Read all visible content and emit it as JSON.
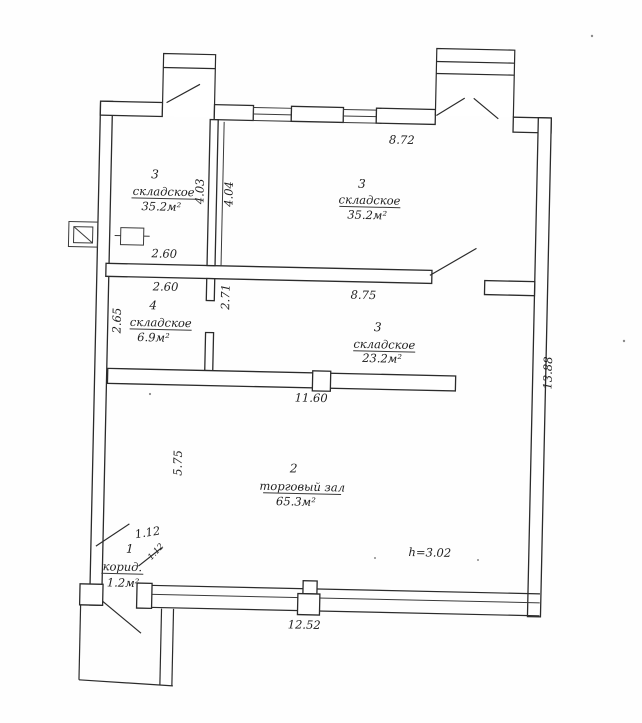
{
  "plan": {
    "rooms": [
      {
        "id": "storage-top-left",
        "number": "3",
        "name": "складское",
        "area": "35.2м²"
      },
      {
        "id": "storage-top-right",
        "number": "3",
        "name": "складское",
        "area": "35.2м²"
      },
      {
        "id": "storage-small",
        "number": "4",
        "name": "складское",
        "area": "6.9м²"
      },
      {
        "id": "storage-middle",
        "number": "3",
        "name": "складское",
        "area": "23.2м²"
      },
      {
        "id": "trade-hall",
        "number": "2",
        "name": "торговый зал",
        "area": "65.3м²"
      },
      {
        "id": "corridor",
        "number": "1",
        "name": "корид.",
        "area": "1.2м²"
      }
    ],
    "dimensions": {
      "top_window_run": "8.72",
      "room_tl_height": "4.03",
      "room_tr_height": "4.04",
      "storage_tl_width": "2.60",
      "storage_small_width": "2.60",
      "partition_height": "2.71",
      "storage_small_height": "2.65",
      "mid_wall_run": "8.75",
      "hall_wall_run": "11.60",
      "hall_left_height": "5.75",
      "right_wall_height": "13.88",
      "bottom_window_run": "12.52",
      "corridor_width": "1.12",
      "corridor_door_width": "1.12",
      "ceiling_height": "h=3.02"
    },
    "ink_color": "#2b2b2b"
  }
}
